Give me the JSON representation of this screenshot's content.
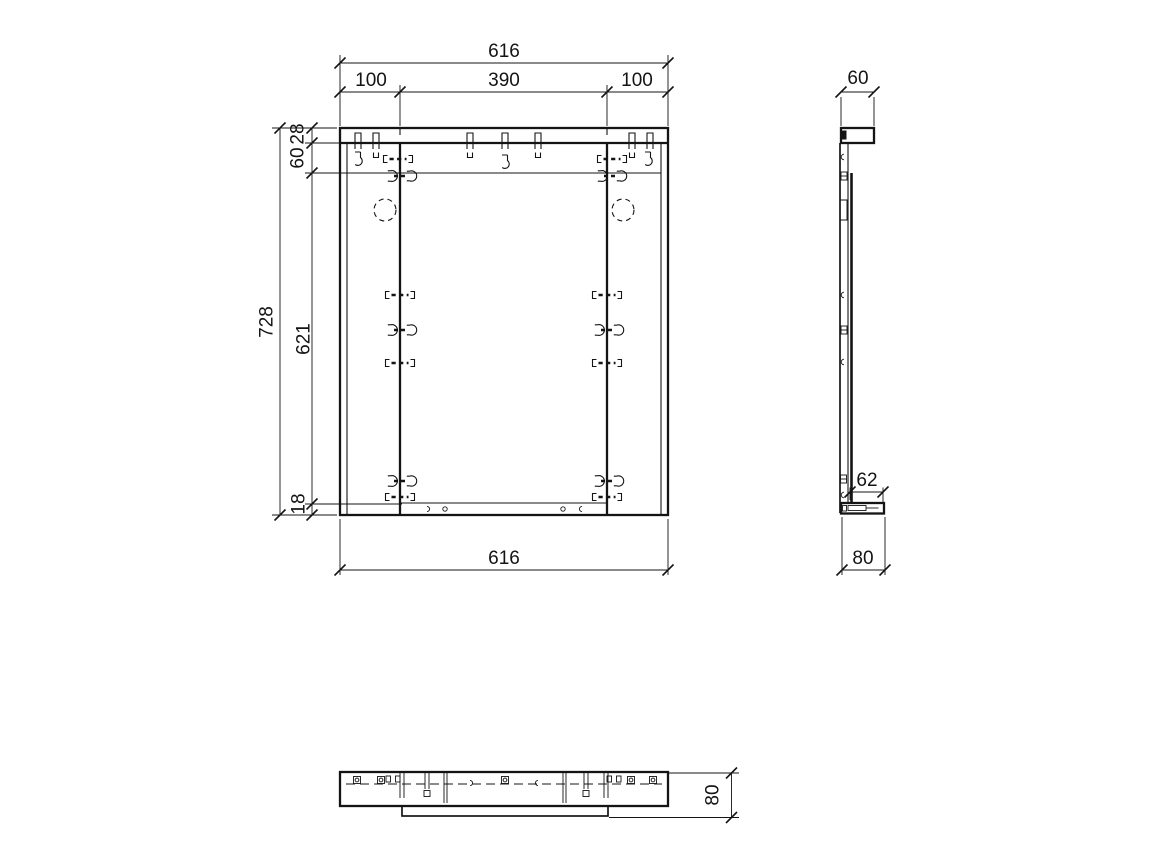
{
  "dims": {
    "front": {
      "overall_top": "616",
      "left_span": "100",
      "center_span": "390",
      "right_span": "100",
      "overall_height": "728",
      "rail_height": "28",
      "rail_offset": "60",
      "panel_height": "621",
      "bottom_inset": "18",
      "overall_bottom": "616"
    },
    "side": {
      "rail_depth": "60",
      "bottom_inner": "62",
      "bottom_rail_depth": "80"
    },
    "bottom": {
      "depth": "80"
    }
  }
}
